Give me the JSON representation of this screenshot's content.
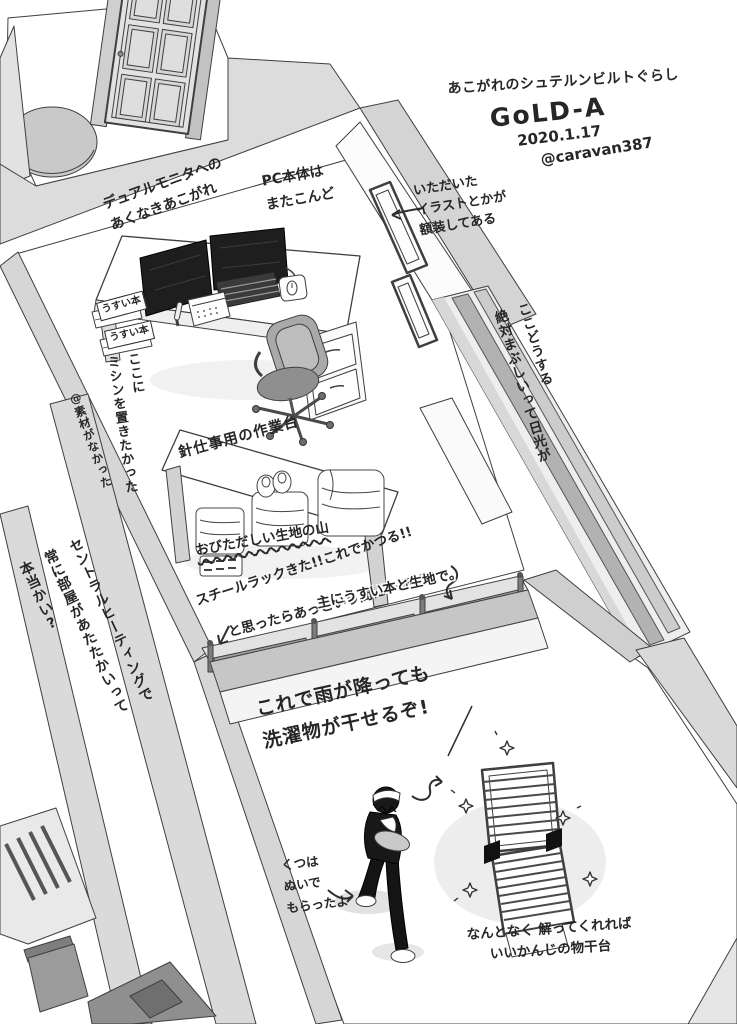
{
  "meta": {
    "title": "あこがれのシュテルンビルトぐらし",
    "room_name": "GoLD-A",
    "date": "2020.1.17",
    "credit": "@caravan387"
  },
  "annotations": {
    "dual_monitor": {
      "text": "デュアルモニタへの\nあくなきあこがれ"
    },
    "pc_tower": {
      "text": "PC本体は\nまたこんど"
    },
    "framed_art": {
      "text": "いただいた\nイラストとかが\n額装してある"
    },
    "window_glare": {
      "text": "ここどうする\n絶対まぶしいって日光が"
    },
    "thin_book_label_1": {
      "text": "うすい本"
    },
    "thin_book_label_2": {
      "text": "うすい本"
    },
    "sewing_machine_spot": {
      "text": "ここに\nミシンを置きたかった"
    },
    "no_material": {
      "text": "@素材がなかった"
    },
    "work_table": {
      "text": "針仕事用の作業台"
    },
    "fabric_mountain": {
      "text": "おびただしい生地の山"
    },
    "steel_rack_win": {
      "text": "スチールラックきた!!これでかつる!!"
    },
    "rack_filled": {
      "text": "と思ったらあっという間に一杯だ!!"
    },
    "rack_contents": {
      "text": "主にうすい本と生地で。"
    },
    "central_heating": {
      "text": "セントラルヒーティングで\n常に部屋があたたかいって\n本当かい?"
    },
    "indoor_laundry": {
      "text": "これで雨が降っても\n洗濯物が干せるぞ!"
    },
    "shoes_off": {
      "text": "くつは\nぬいで\nもらったよ"
    },
    "drying_stand": {
      "text": "なんとなく 解ってくれれば\nいいかんじの物干台"
    }
  },
  "colors": {
    "ink": "#2b2b2b",
    "line": "#3f3f3f",
    "paper": "#ffffff",
    "wall_light": "#e6e6e6",
    "wall_mid": "#d6d6d6",
    "wall_dark": "#bdbdbd",
    "screen": "#1e1e1e"
  }
}
